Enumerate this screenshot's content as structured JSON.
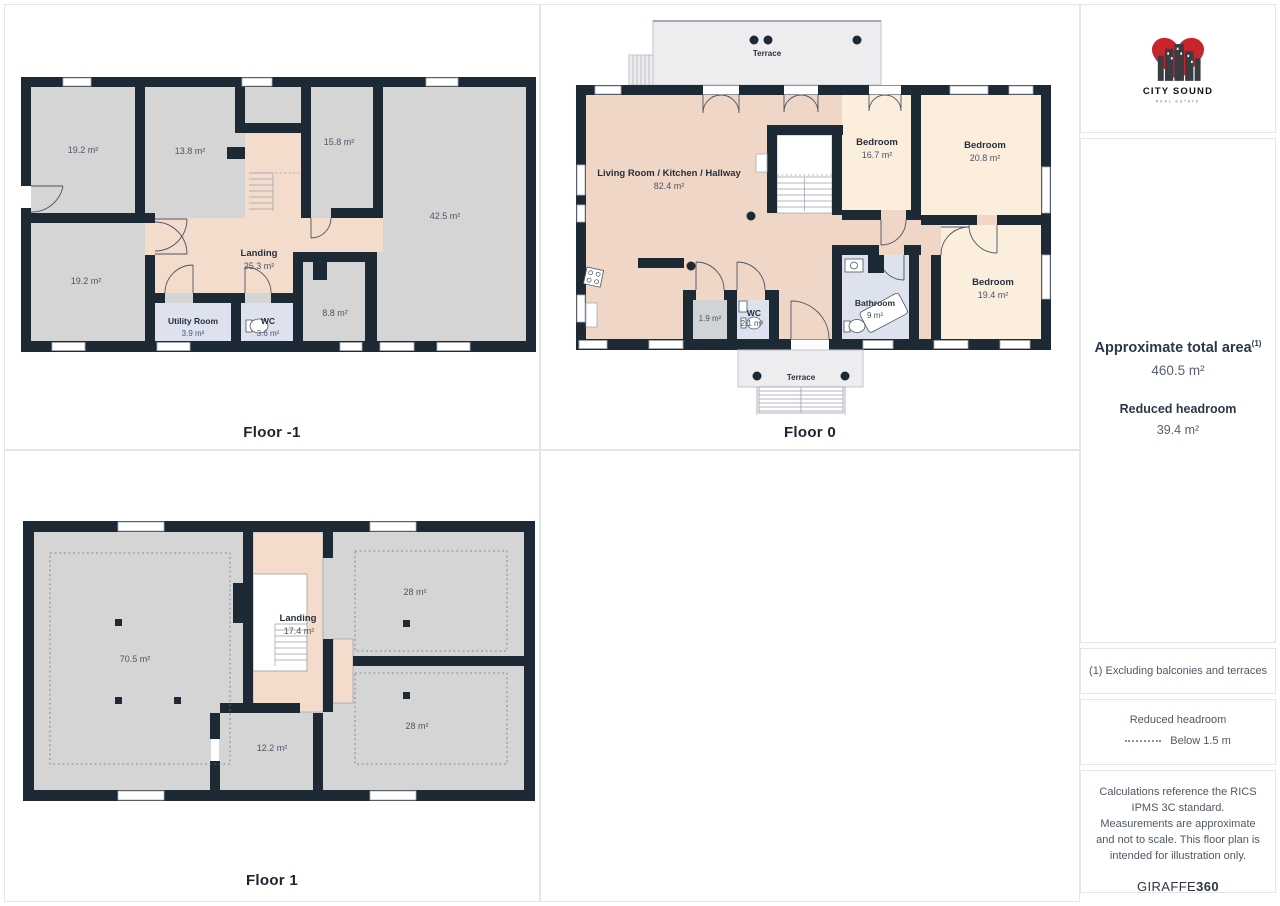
{
  "brand": {
    "name": "CITY SOUND",
    "tagline": "REAL ESTATE"
  },
  "floors": [
    {
      "label": "Floor -1",
      "rooms": [
        {
          "name": "",
          "area": "19.2 m²"
        },
        {
          "name": "",
          "area": "13.8 m²"
        },
        {
          "name": "",
          "area": "15.8 m²"
        },
        {
          "name": "",
          "area": "42.5 m²"
        },
        {
          "name": "",
          "area": "19.2 m²"
        },
        {
          "name": "Landing",
          "area": "25.3 m²"
        },
        {
          "name": "Utility Room",
          "area": "3.9 m²"
        },
        {
          "name": "WC",
          "area": "3.6 m²"
        },
        {
          "name": "",
          "area": "8.8 m²"
        }
      ]
    },
    {
      "label": "Floor 0",
      "terraces": [
        "Terrace",
        "Terrace"
      ],
      "rooms": [
        {
          "name": "Living Room / Kitchen / Hallway",
          "area": "82.4 m²"
        },
        {
          "name": "Bedroom",
          "area": "16.7 m²"
        },
        {
          "name": "Bedroom",
          "area": "20.8 m²"
        },
        {
          "name": "Bedroom",
          "area": "19.4 m²"
        },
        {
          "name": "Bathroom",
          "area": "9 m²"
        },
        {
          "name": "WC",
          "area": "2.1 m²"
        },
        {
          "name": "",
          "area": "1.9 m²"
        }
      ]
    },
    {
      "label": "Floor 1",
      "rooms": [
        {
          "name": "",
          "area": "70.5 m²"
        },
        {
          "name": "Landing",
          "area": "17.4 m²"
        },
        {
          "name": "",
          "area": "28 m²"
        },
        {
          "name": "",
          "area": "28 m²"
        },
        {
          "name": "",
          "area": "12.2 m²"
        }
      ]
    }
  ],
  "summary": {
    "total_area_label": "Approximate total area",
    "total_area_marker": "(1)",
    "total_area_value": "460.5 m²",
    "reduced_headroom_label": "Reduced headroom",
    "reduced_headroom_value": "39.4 m²"
  },
  "footnote": "(1) Excluding balconies and terraces",
  "legend": {
    "title": "Reduced headroom",
    "dashed_label": "Below 1.5 m"
  },
  "disclaimer": "Calculations reference the RICS IPMS 3C standard. Measurements are approximate and not to scale. This floor plan is intended for illustration only.",
  "credit": {
    "normal": "GIRAFFE",
    "bold": "360"
  },
  "colors": {
    "wall": "#1e2936",
    "hallway_pink": "#f4dccd",
    "living_pink": "#efd6c7",
    "bedroom_cream": "#fbeedd",
    "bathroom_blue": "#dde2ee",
    "room_gray": "#d5d5d6",
    "terrace_gray": "#ededef",
    "brand_red": "#c8242c"
  }
}
